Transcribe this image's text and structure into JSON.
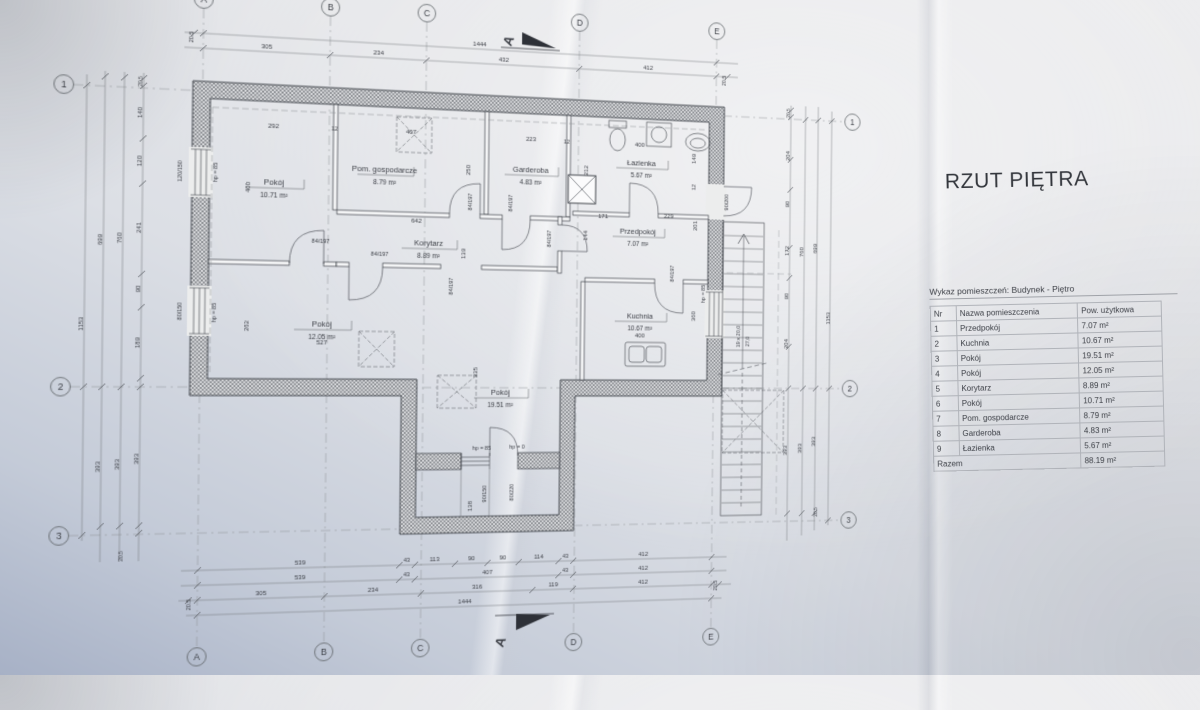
{
  "photo": {
    "title": "RZUT PIĘTRA"
  },
  "table": {
    "caption": "Wykaz pomieszczeń: Budynek - Piętro",
    "columns": [
      "Nr",
      "Nazwa pomieszczenia",
      "Pow. użytkowa"
    ],
    "rows": [
      [
        "1",
        "Przedpokój",
        "7.07 m²"
      ],
      [
        "2",
        "Kuchnia",
        "10.67 m²"
      ],
      [
        "3",
        "Pokój",
        "19.51 m²"
      ],
      [
        "4",
        "Pokój",
        "12.05 m²"
      ],
      [
        "5",
        "Korytarz",
        "8.89 m²"
      ],
      [
        "6",
        "Pokój",
        "10.71 m²"
      ],
      [
        "7",
        "Pom. gospodarcze",
        "8.79 m²"
      ],
      [
        "8",
        "Garderoba",
        "4.83 m²"
      ],
      [
        "9",
        "Łazienka",
        "5.67 m²"
      ]
    ],
    "total_label": "Razem",
    "total_value": "88.19 m²"
  },
  "plan": {
    "grid_cols": [
      "A",
      "B",
      "C",
      "D",
      "E"
    ],
    "grid_rows": [
      "1",
      "2",
      "3"
    ],
    "section_label": "A",
    "rooms": [
      {
        "name": "Pokój",
        "area": "10.71 m²",
        "x": 281,
        "y": 196
      },
      {
        "name": "Pom. gospodarcze",
        "area": "8.79 m²",
        "x": 385,
        "y": 180
      },
      {
        "name": "Garderoba",
        "area": "4.83 m²",
        "x": 528,
        "y": 175
      },
      {
        "name": "Łazienka",
        "area": "5.67 m²",
        "x": 641,
        "y": 164
      },
      {
        "name": "Przedpokój",
        "area": "7.07 m²",
        "x": 638,
        "y": 233
      },
      {
        "name": "Korytarz",
        "area": "8.89 m²",
        "x": 428,
        "y": 250
      },
      {
        "name": "Pokój",
        "area": "12.05 m²",
        "x": 327,
        "y": 330
      },
      {
        "name": "Kuchnia",
        "area": "10.67 m²",
        "x": 641,
        "y": 318
      },
      {
        "name": "Pokój",
        "area": "19.51 m²",
        "x": 500,
        "y": 395
      }
    ],
    "labels": [
      {
        "t": "20.5",
        "x": 206,
        "y": 60,
        "r": -90,
        "s": 5.5
      },
      {
        "t": "1444",
        "x": 476,
        "y": 53
      },
      {
        "t": "305",
        "x": 273,
        "y": 67
      },
      {
        "t": "234",
        "x": 378,
        "y": 67
      },
      {
        "t": "432",
        "x": 500,
        "y": 67
      },
      {
        "t": "412",
        "x": 647,
        "y": 67
      },
      {
        "t": "20.5",
        "x": 729,
        "y": 74,
        "r": -90,
        "s": 5.5
      },
      {
        "t": "292",
        "x": 280,
        "y": 142
      },
      {
        "t": "12",
        "x": 337,
        "y": 142,
        "s": 5.5
      },
      {
        "t": "407",
        "x": 410,
        "y": 142
      },
      {
        "t": "223",
        "x": 528,
        "y": 144
      },
      {
        "t": "12",
        "x": 564,
        "y": 145,
        "s": 5.5
      },
      {
        "t": "400",
        "x": 639,
        "y": 145
      },
      {
        "t": "149",
        "x": 698,
        "y": 155,
        "r": -90
      },
      {
        "t": "12",
        "x": 698,
        "y": 184,
        "r": -90,
        "s": 5.5
      },
      {
        "t": "400",
        "x": 259,
        "y": 199,
        "r": -90
      },
      {
        "t": "hp = 85",
        "x": 229,
        "y": 186,
        "r": -90,
        "s": 5.5
      },
      {
        "t": "120/150",
        "x": 197,
        "y": 186,
        "r": -90,
        "s": 5.5
      },
      {
        "t": "250",
        "x": 468,
        "y": 175,
        "r": -90
      },
      {
        "t": "212",
        "x": 586,
        "y": 171,
        "r": -90
      },
      {
        "t": "642",
        "x": 416,
        "y": 228
      },
      {
        "t": "139",
        "x": 464,
        "y": 257,
        "r": -90
      },
      {
        "t": "84/197",
        "x": 470,
        "y": 206,
        "r": -90,
        "s": 5.5
      },
      {
        "t": "84/197",
        "x": 510,
        "y": 206,
        "r": -90,
        "s": 5.5
      },
      {
        "t": "84/197",
        "x": 549,
        "y": 240,
        "r": -90,
        "s": 5.5
      },
      {
        "t": "171",
        "x": 602,
        "y": 218
      },
      {
        "t": "229",
        "x": 670,
        "y": 216
      },
      {
        "t": "144",
        "x": 586,
        "y": 236,
        "r": -90
      },
      {
        "t": "201",
        "x": 700,
        "y": 223,
        "r": -90
      },
      {
        "t": "84/197",
        "x": 325,
        "y": 250,
        "s": 5.5
      },
      {
        "t": "84/197",
        "x": 381,
        "y": 261,
        "s": 5.5
      },
      {
        "t": "hp = 85",
        "x": 229,
        "y": 318,
        "r": -90,
        "s": 5.5
      },
      {
        "t": "80/150",
        "x": 198,
        "y": 317,
        "r": -90,
        "s": 5.5
      },
      {
        "t": "262",
        "x": 259,
        "y": 330,
        "r": -90
      },
      {
        "t": "527",
        "x": 327,
        "y": 347
      },
      {
        "t": "84/197",
        "x": 452,
        "y": 289,
        "r": -90,
        "s": 5.5
      },
      {
        "t": "84/197",
        "x": 676,
        "y": 272,
        "r": -90,
        "s": 5.5
      },
      {
        "t": "400",
        "x": 641,
        "y": 337
      },
      {
        "t": "360",
        "x": 699,
        "y": 315,
        "r": -90
      },
      {
        "t": "hp = 85",
        "x": 709,
        "y": 292,
        "r": -90,
        "s": 5.5
      },
      {
        "t": "90/200",
        "x": 733,
        "y": 198,
        "r": -90,
        "s": 5.5
      },
      {
        "t": "335",
        "x": 477,
        "y": 373,
        "r": -90
      },
      {
        "t": "hp = 85",
        "x": 482,
        "y": 449,
        "s": 5.5
      },
      {
        "t": "hp = 0",
        "x": 517,
        "y": 448,
        "s": 5.5
      },
      {
        "t": "90/150",
        "x": 487,
        "y": 492,
        "r": -90,
        "s": 5.5
      },
      {
        "t": "80/220",
        "x": 514,
        "y": 491,
        "r": -90,
        "s": 5.5
      },
      {
        "t": "138",
        "x": 473,
        "y": 504,
        "r": -90
      },
      {
        "t": "19 x 20,0",
        "x": 747,
        "y": 335,
        "r": -90,
        "s": 5.5
      },
      {
        "t": "27,0",
        "x": 757,
        "y": 340,
        "r": -90,
        "s": 5.5
      },
      {
        "t": "539",
        "x": 309,
        "y": 557
      },
      {
        "t": "43",
        "x": 410,
        "y": 557,
        "s": 5.5
      },
      {
        "t": "113",
        "x": 437,
        "y": 557
      },
      {
        "t": "90",
        "x": 473,
        "y": 557
      },
      {
        "t": "90",
        "x": 504,
        "y": 557
      },
      {
        "t": "114",
        "x": 540,
        "y": 557
      },
      {
        "t": "43",
        "x": 567,
        "y": 557,
        "s": 5.5
      },
      {
        "t": "412",
        "x": 647,
        "y": 557
      },
      {
        "t": "539",
        "x": 309,
        "y": 571
      },
      {
        "t": "43",
        "x": 410,
        "y": 571,
        "s": 5.5
      },
      {
        "t": "407",
        "x": 489,
        "y": 571
      },
      {
        "t": "43",
        "x": 567,
        "y": 571,
        "s": 5.5
      },
      {
        "t": "412",
        "x": 647,
        "y": 571
      },
      {
        "t": "20.5",
        "x": 209,
        "y": 592,
        "r": -90,
        "s": 5.5
      },
      {
        "t": "305",
        "x": 273,
        "y": 585
      },
      {
        "t": "234",
        "x": 378,
        "y": 585
      },
      {
        "t": "316",
        "x": 479,
        "y": 585
      },
      {
        "t": "119",
        "x": 555,
        "y": 585
      },
      {
        "t": "412",
        "x": 647,
        "y": 585
      },
      {
        "t": "20.5",
        "x": 725,
        "y": 589,
        "r": -90,
        "s": 5.5
      },
      {
        "t": "1444",
        "x": 467,
        "y": 599
      },
      {
        "t": "20.5",
        "x": 161,
        "y": 104,
        "r": -90,
        "s": 5
      },
      {
        "t": "140",
        "x": 161,
        "y": 133,
        "r": -90
      },
      {
        "t": "120",
        "x": 161,
        "y": 178,
        "r": -90
      },
      {
        "t": "241",
        "x": 161,
        "y": 240,
        "r": -90
      },
      {
        "t": "90",
        "x": 161,
        "y": 297,
        "r": -90
      },
      {
        "t": "189",
        "x": 161,
        "y": 347,
        "r": -90
      },
      {
        "t": "393",
        "x": 161,
        "y": 455,
        "r": -90
      },
      {
        "t": "20.5",
        "x": 148,
        "y": 545,
        "r": -90,
        "s": 5
      },
      {
        "t": "760",
        "x": 144,
        "y": 250,
        "r": -90
      },
      {
        "t": "393",
        "x": 144,
        "y": 460,
        "r": -90
      },
      {
        "t": "699",
        "x": 127,
        "y": 252,
        "r": -90
      },
      {
        "t": "393",
        "x": 127,
        "y": 462,
        "r": -90
      },
      {
        "t": "1153",
        "x": 111,
        "y": 330,
        "r": -90
      },
      {
        "t": "20.5",
        "x": 799,
        "y": 104,
        "r": -90,
        "s": 5
      },
      {
        "t": "204",
        "x": 799,
        "y": 148,
        "r": -90
      },
      {
        "t": "90",
        "x": 799,
        "y": 198,
        "r": -90
      },
      {
        "t": "172",
        "x": 799,
        "y": 246,
        "r": -90
      },
      {
        "t": "90",
        "x": 799,
        "y": 293,
        "r": -90
      },
      {
        "t": "204",
        "x": 799,
        "y": 342,
        "r": -90
      },
      {
        "t": "393",
        "x": 799,
        "y": 452,
        "r": -90
      },
      {
        "t": "760",
        "x": 815,
        "y": 247,
        "r": -90
      },
      {
        "t": "393",
        "x": 815,
        "y": 450,
        "r": -90
      },
      {
        "t": "699",
        "x": 830,
        "y": 243,
        "r": -90
      },
      {
        "t": "393",
        "x": 830,
        "y": 443,
        "r": -90
      },
      {
        "t": "1153",
        "x": 845,
        "y": 315,
        "r": -90
      },
      {
        "t": "20.5",
        "x": 833,
        "y": 516,
        "r": -90,
        "s": 5
      }
    ]
  }
}
